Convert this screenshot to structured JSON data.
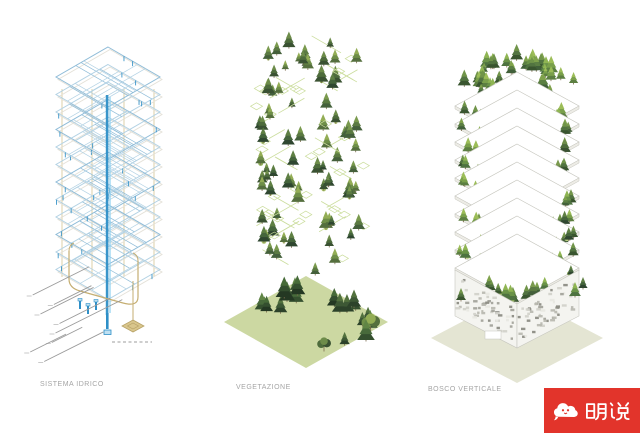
{
  "page": {
    "background": "#ffffff"
  },
  "figures": [
    {
      "key": "sistema-idrico",
      "label": "SISTEMA IDRICO"
    },
    {
      "key": "vegetazione",
      "label": "VEGETAZIONE"
    },
    {
      "key": "bosco-verticale",
      "label": "BOSCO VERTICALE"
    }
  ],
  "caption_color": "#a5a5a5",
  "banner": {
    "text": "明说",
    "background": "#e2342b",
    "foreground": "#ffffff",
    "icon": "cloud-face-icon"
  },
  "colors": {
    "wire_blue": "#8fbcd8",
    "wire_blue_light": "#b3d2e4",
    "wire_ghost": "#e4e1d8",
    "pipe_blue": "#2e8fc7",
    "pipe_blue_light": "#8ed0f0",
    "pipe_fill": "#bfe0f2",
    "structure_tan": "#cdb97e",
    "podium_tan": "#c5ae72",
    "pedestal_fill": "#d9c68c",
    "pedestal_edge": "#b7a267",
    "leader_gray": "#9a9a9a",
    "tick_gray": "#bdbdbd",
    "plan_green": "#cbdd9d",
    "ground_green": "#ccd8a2",
    "ground_pale": "#e4e5d3",
    "slab_white": "#ffffff",
    "slab_edge": "#c6c6be",
    "fascia": "#edece6",
    "facade_fill": "#f4f4f0",
    "mosaic": [
      "#b9b9b1",
      "#a3a39b",
      "#8c8c84",
      "#d2d2ca",
      "#e8e8e2"
    ],
    "trunk": "#7c6b4e",
    "bush": [
      "#a9c36a",
      "#b9cf7e",
      "#8fae58"
    ],
    "tree_mid": [
      [
        "#3a5232",
        "#4e6c3c",
        "#6d8c4a"
      ],
      [
        "#2f4730",
        "#45653c",
        "#5f8044"
      ],
      [
        "#556f3e",
        "#6f8f48",
        "#93ad55"
      ],
      [
        "#44603b",
        "#5b7a42",
        "#7a9a4e"
      ]
    ],
    "tree_bright": [
      [
        "#41603a",
        "#5b7f43",
        "#7fa24c"
      ],
      [
        "#4e7340",
        "#6a9348",
        "#8fb553"
      ],
      [
        "#39552f",
        "#527441",
        "#709449"
      ],
      [
        "#5c7f41",
        "#7aa04b",
        "#9cbd58"
      ]
    ],
    "tree_dark": [
      [
        "#2c422a",
        "#3d5835",
        "#52713e"
      ],
      [
        "#35502f",
        "#486a3b",
        "#608545"
      ],
      [
        "#243823",
        "#344f2f",
        "#476b39"
      ]
    ]
  }
}
